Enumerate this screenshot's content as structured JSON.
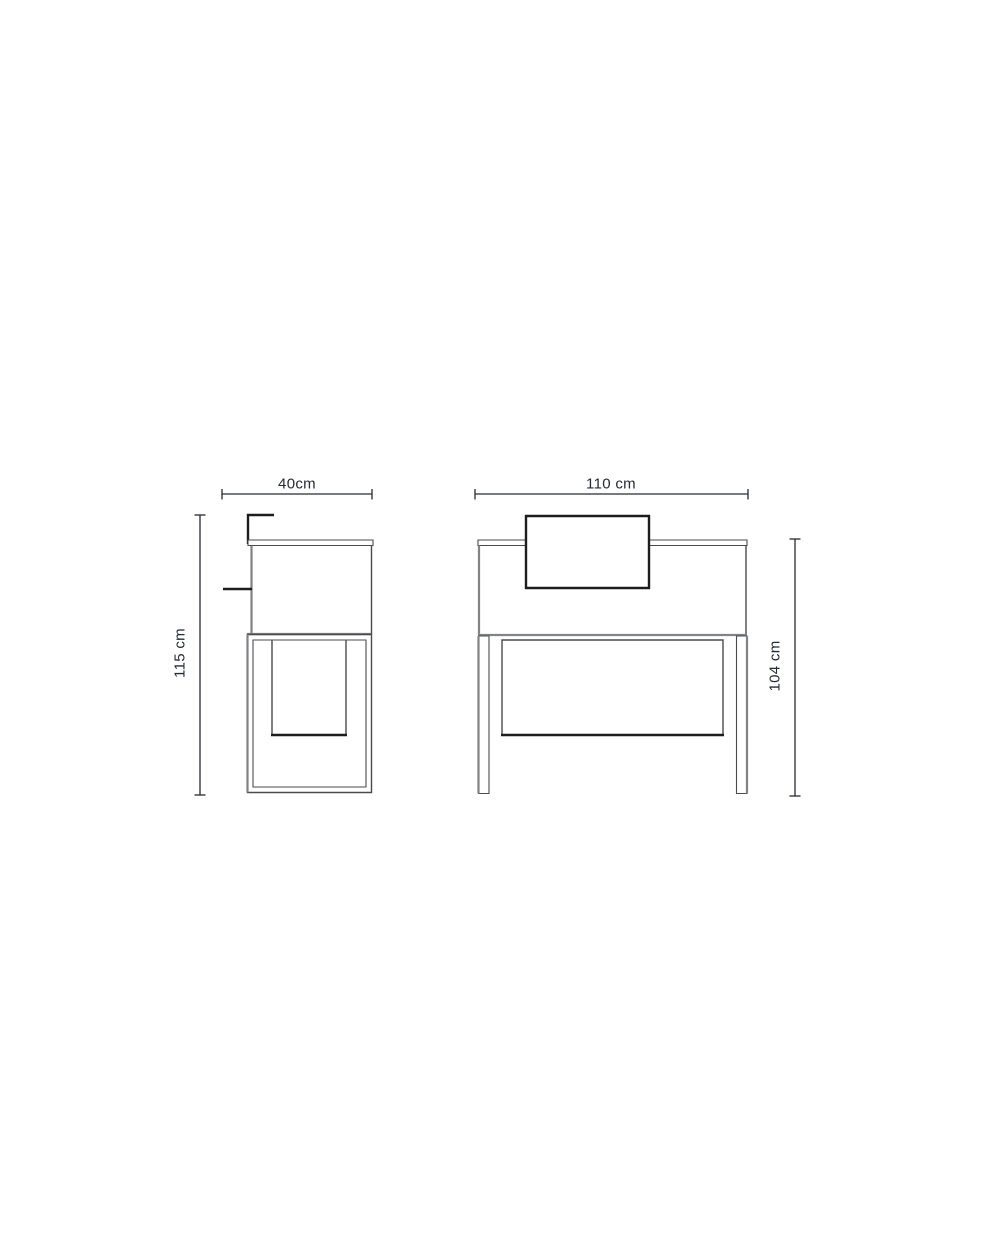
{
  "colors": {
    "surface": "#ffffff",
    "dim": "#262a33",
    "ink": "#1d1d1f",
    "line_dark": "#4a4b4f",
    "line_mid": "#828387"
  },
  "views": {
    "side": {
      "width_label": "40cm",
      "height_label": "115 cm"
    },
    "front": {
      "width_label": "110 cm",
      "height_label": "104 cm"
    }
  }
}
